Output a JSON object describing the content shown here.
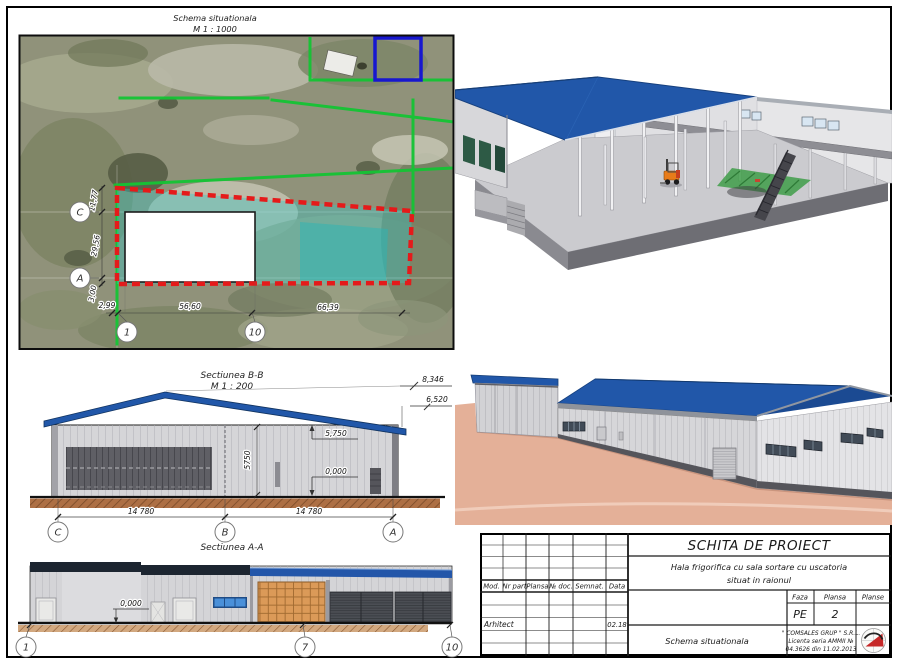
{
  "site_plan": {
    "title": "Schema situationala",
    "scale": "M 1 : 1000",
    "dim_left": [
      "11,77",
      "29,56",
      "3,00"
    ],
    "dim_bottom": [
      "2,99",
      "56,60",
      "66,39"
    ],
    "axes_left": [
      "C",
      "A"
    ],
    "axes_bottom": [
      "1",
      "10"
    ]
  },
  "section_bb": {
    "title": "Sectiunea B-B",
    "scale": "M 1 : 200",
    "elev_ridge": "8,346",
    "elev_eave": "6,520",
    "level_top": "5,750",
    "level_floor": "0,000",
    "dim_height": "5750",
    "spans": [
      "14 780",
      "14 780"
    ],
    "axes": [
      "C",
      "B",
      "A"
    ]
  },
  "section_aa": {
    "title": "Sectiunea A-A",
    "level_floor": "0,000",
    "axes": [
      "1",
      "7",
      "10"
    ]
  },
  "title_block": {
    "doc_title": "SCHITA DE PROIECT",
    "project": [
      "Hala frigorifica cu sala sortare cu uscatoria",
      "situat in raionul"
    ],
    "columns": [
      "Mod.",
      "Nr part",
      "Plansa",
      "№ doc.",
      "Semnat.",
      "Data"
    ],
    "role": "Arhitect",
    "date": "02.18",
    "faza": {
      "label": "Faza",
      "value": "PE"
    },
    "plansa": {
      "label": "Plansa",
      "value": "2"
    },
    "planse": {
      "label": "Planse",
      "value": ""
    },
    "sheet_name": "Schema situationala",
    "company": [
      "\" COMSALES GRUP \" S.R.L.",
      "Licenta seria  AMMII  №",
      "04.3626 din 11.02.2013"
    ]
  },
  "colors": {
    "roof_blue": "#2157a9",
    "boundary_red": "#e51a1a",
    "parcel_green": "#14c434",
    "overlay_cyan": "#35c4c4",
    "ground_salmon": "#e4b098",
    "ground_brown": "#ad6f44",
    "dark_navy": "#1c2530",
    "orange_door": "#db9a58"
  }
}
